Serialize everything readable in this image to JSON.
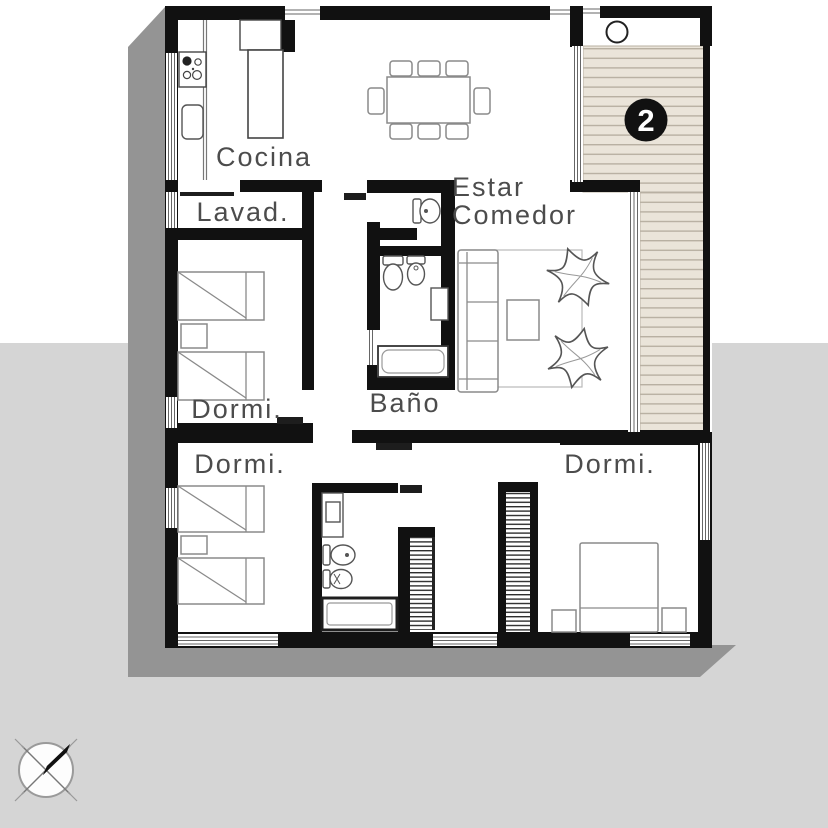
{
  "plan": {
    "title": "apartment-floor-plan",
    "unit_badge": "2",
    "rooms": {
      "cocina": {
        "label": "Cocina"
      },
      "lavadero": {
        "label": "Lavad."
      },
      "estar_comedor": {
        "label_line1": "Estar",
        "label_line2": "Comedor"
      },
      "bano": {
        "label": "Baño"
      },
      "dormitorio_1": {
        "label": "Dormi."
      },
      "dormitorio_2": {
        "label": "Dormi."
      },
      "dormitorio_3": {
        "label": "Dormi."
      }
    },
    "features": [
      "stove-icon",
      "kitchen-sink-icon",
      "kitchen-island",
      "dining-table-8-chairs",
      "sofa",
      "coffee-table",
      "butterfly-chair",
      "butterfly-chair",
      "area-rug",
      "toilet-icon",
      "bidet-icon",
      "bathtub-icon",
      "vanity-sink-icon",
      "single-bed",
      "single-bed",
      "single-bed",
      "single-bed",
      "double-bed",
      "nightstand",
      "wardrobe-shelving",
      "wood-deck",
      "north-compass-icon"
    ]
  },
  "colors": {
    "wall": "#111111",
    "deck_fill": "#eae4d9",
    "deck_line": "#b8b0a2",
    "background_band": "#d5d5d5",
    "shadow": "#949494",
    "label_text": "#4c4c4c",
    "furniture_outline": "#8a8a8a",
    "badge_background": "#111111",
    "badge_text": "#ffffff"
  },
  "compass": {
    "needle_direction": "north-east"
  }
}
